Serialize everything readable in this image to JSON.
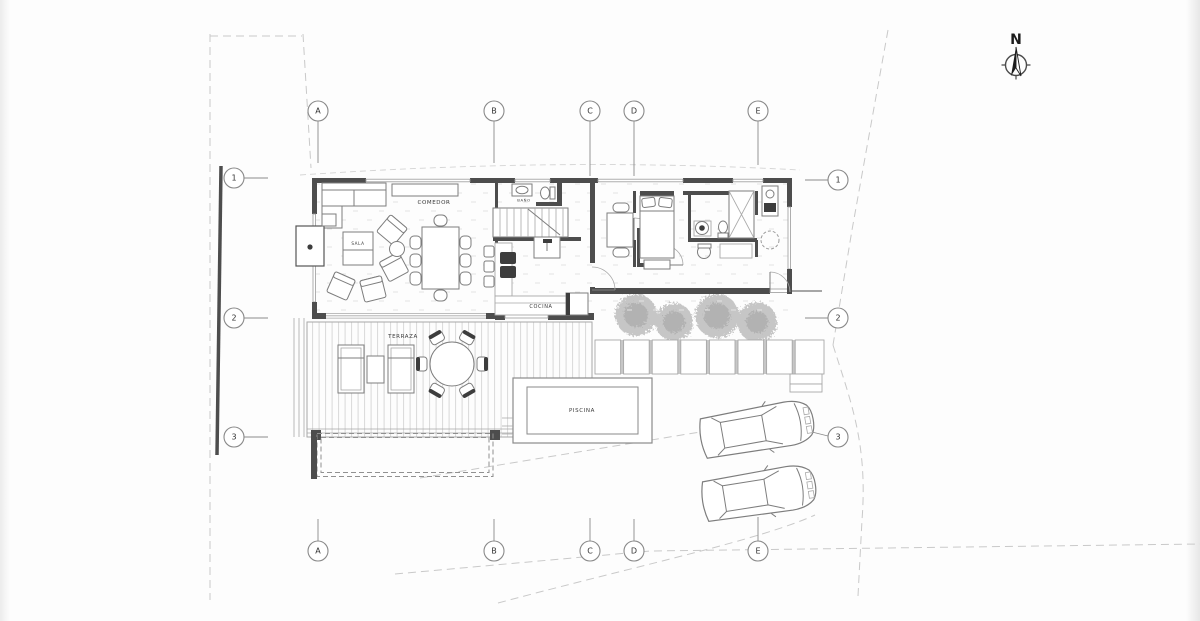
{
  "compass": {
    "label": "N"
  },
  "grid": {
    "columns": [
      {
        "id": "A"
      },
      {
        "id": "B"
      },
      {
        "id": "C"
      },
      {
        "id": "D"
      },
      {
        "id": "E"
      }
    ],
    "rows": [
      {
        "id": "1"
      },
      {
        "id": "2"
      },
      {
        "id": "3"
      }
    ]
  },
  "rooms": {
    "dining_label": "COMEDOR",
    "living_label": "SALA",
    "bath_label": "BAÑO",
    "kitchen_label": "COCINA",
    "terrace_label": "TERRAZA",
    "pool_label": "PISCINA"
  },
  "colors": {
    "wall": "#4d4d4d",
    "line": "#8a8a8a",
    "light_line": "#c9c9c9",
    "deck_line": "#d8d8d8",
    "tree": "#c6c6c6",
    "text": "#3a3a3a"
  }
}
